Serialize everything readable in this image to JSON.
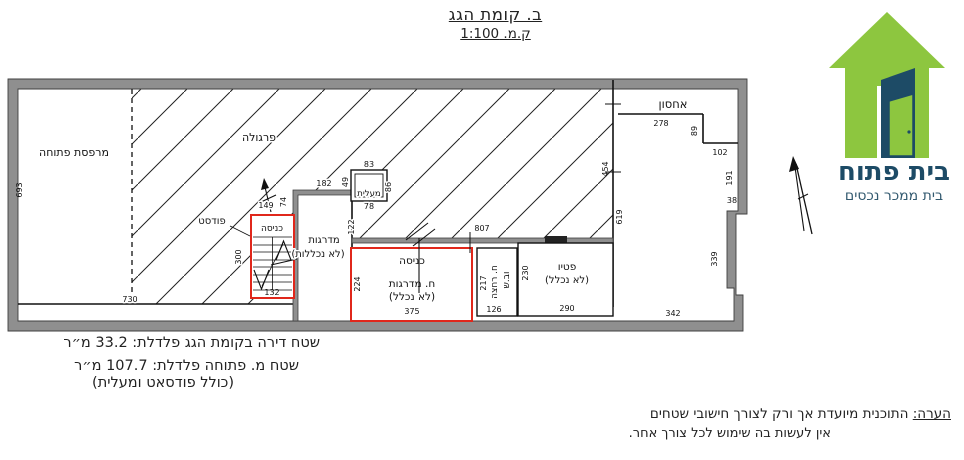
{
  "title": {
    "line1": "ב. קומת הגג",
    "line2": "ק.מ. 1:100"
  },
  "logo": {
    "name": "בית פתוח",
    "tagline": "בית ממכר נכסים",
    "house_green": "#8dc63f",
    "door_navy": "#1d4b66"
  },
  "plan": {
    "accent_red": "#e0271b",
    "labels": {
      "open_balcony": "מרפסת פתוחה",
      "pergola": "פרגולה",
      "podest": "פודסט",
      "stairs_entry": "כניסה",
      "stairs_note1": "מדרגות",
      "stairs_note2": "(לא נכללות)",
      "elevator": "מעלית",
      "entrance": "כניסה",
      "stairwell": "ח. מדרגות",
      "not_included": "(לא נכלל)",
      "bathroom": "ח. רחצה",
      "toilet": "וב.ש",
      "patio": "פטיו",
      "patio_note": "(לא נכלל)",
      "storage": "אחסון"
    },
    "dims": {
      "d693": "693",
      "d730": "730",
      "d149": "149",
      "d74": "74",
      "d300": "300",
      "d132": "132",
      "d182": "182",
      "d83": "83",
      "d49": "49",
      "d86": "86",
      "d78": "78",
      "d122": "122",
      "d807": "807",
      "d224": "224",
      "d375": "375",
      "d217": "217",
      "d126": "126",
      "d230": "230",
      "d290": "290",
      "d278": "278",
      "d89": "89",
      "d102": "102",
      "d191": "191",
      "d38": "38",
      "d339": "339",
      "d342": "342",
      "d619": "619",
      "d454": "454"
    }
  },
  "area_notes": {
    "line1": "שטח דירה בקומת הגג פלדלת: 33.2 מ״ר",
    "line2": "שטח מ. פתוחה פלדלת: 107.7 מ״ר",
    "line3": "(כולל פודסאט ומעלית)"
  },
  "disclaimer": {
    "label": "הערה:",
    "line1": "התוכנית מיועדת אך ורק לצורך חישובי שטחים",
    "line2": "אין לעשות בה שימוש לכל צורך אחר."
  }
}
